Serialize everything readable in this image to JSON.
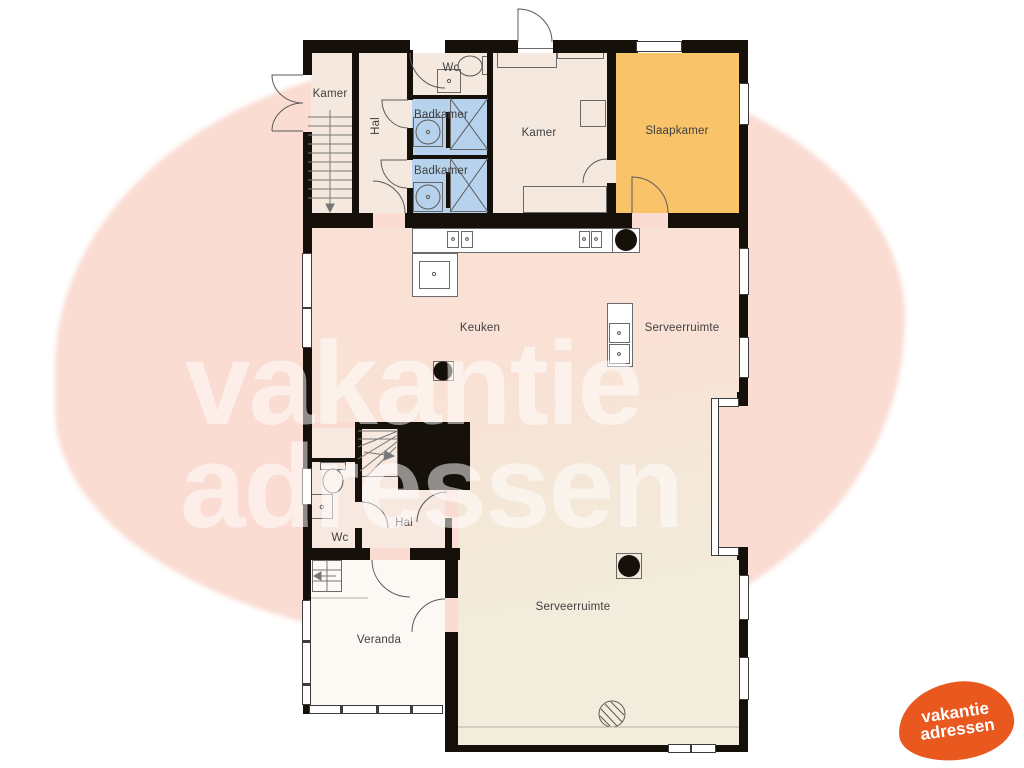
{
  "labels": {
    "kamer_tl": "Kamer",
    "hal_top": "Hal",
    "wc_top": "Wc",
    "badkamer_1": "Badkamer",
    "badkamer_2": "Badkamer",
    "kamer_top": "Kamer",
    "slaapkamer": "Slaapkamer",
    "keuken": "Keuken",
    "serveerruimte_upper": "Serveerruimte",
    "wc_lower": "Wc",
    "hal_lower": "Hal",
    "veranda": "Veranda",
    "serveerruimte_lower": "Serveerruimte"
  },
  "watermark": {
    "line1": "vakantie",
    "line2": "adressen"
  },
  "logo": {
    "line1": "vakantie",
    "line2": "adressen"
  },
  "colors": {
    "wall": "#16100a",
    "line": "#5a5a5a",
    "cream_top": "#f5e9df",
    "blue": "#b7d2ec",
    "orange": "#f8c369",
    "open_top": "#f9e2d5",
    "open_bottom": "#f1ecdb",
    "block_cream": "#f7e9df",
    "veranda": "#fcf8f3",
    "blob": "#fadcd2",
    "wm_text": "rgba(255,255,255,0.52)",
    "logo": "#e8581f"
  }
}
